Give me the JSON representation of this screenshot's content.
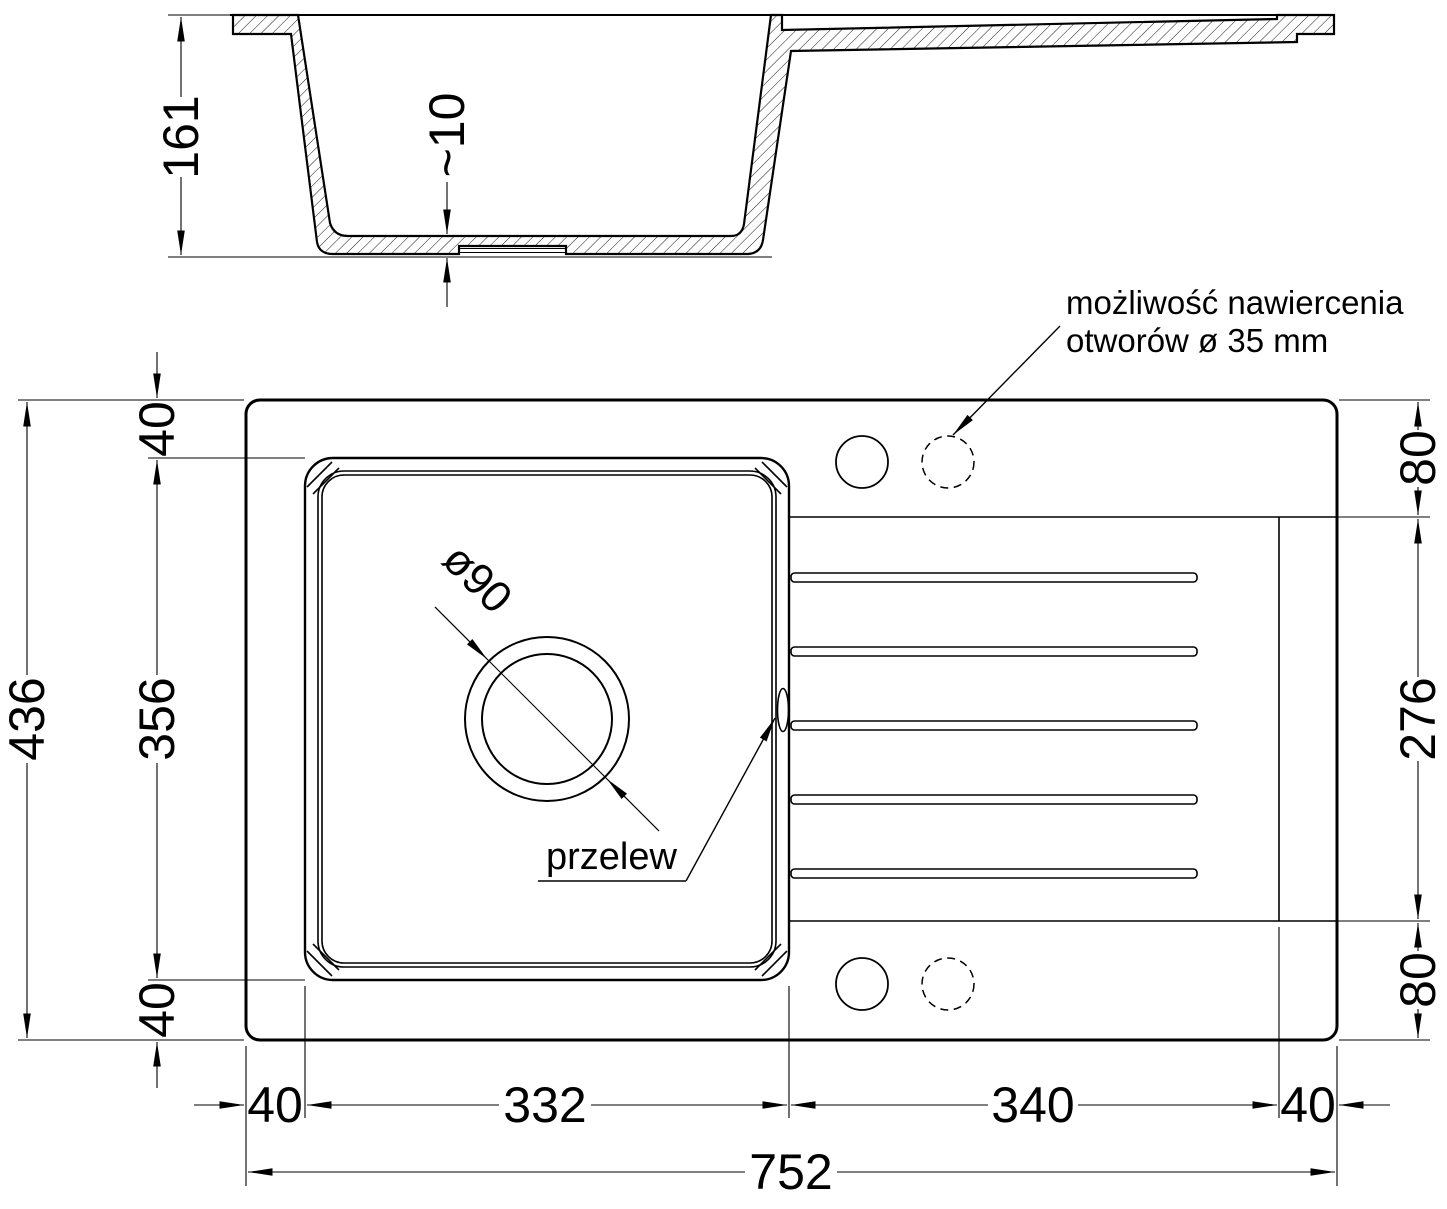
{
  "colors": {
    "background": "#ffffff",
    "line": "#000000"
  },
  "section_view": {
    "depth": "161",
    "bottom_thickness": "~10"
  },
  "plan_view": {
    "note_line1": "możliwość nawiercenia",
    "note_line2": "otworów ø 35 mm",
    "drain_diameter": "ø90",
    "overflow_label": "przelew",
    "dims_left": {
      "top_margin": "40",
      "bowl_length": "356",
      "bottom_margin": "40",
      "total_depth": "436"
    },
    "dims_right": {
      "top_offset": "80",
      "drainer_length": "276",
      "bottom_offset": "80"
    },
    "dims_bottom": {
      "left_margin": "40",
      "bowl_width": "332",
      "drainer_width": "340",
      "right_margin": "40",
      "total_width": "752"
    }
  }
}
